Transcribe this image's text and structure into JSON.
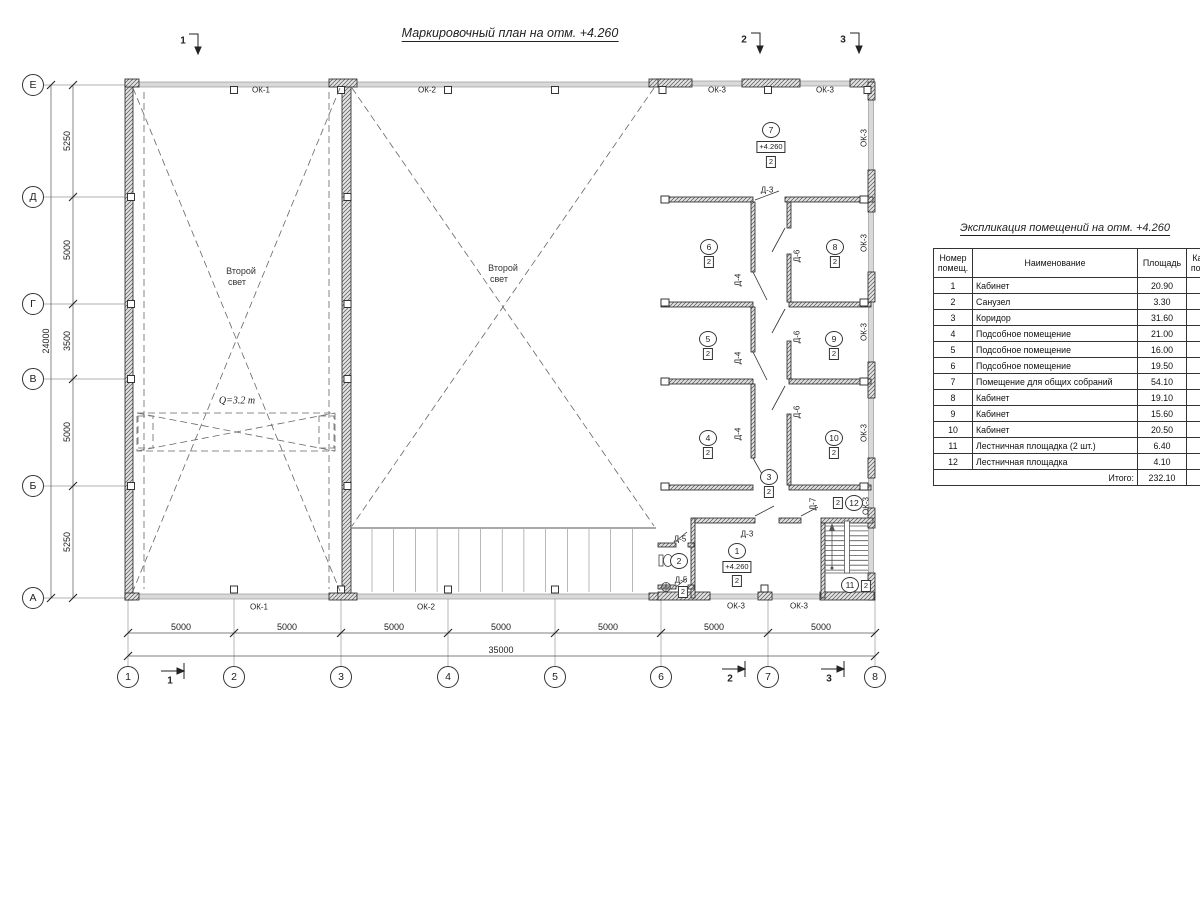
{
  "plan": {
    "title": "Маркировочный план на отм. +4.260",
    "elevation": "+4.260",
    "cat": "2",
    "second_light": [
      "Второй",
      "свет"
    ],
    "crane_label": "Q=3.2 т",
    "sections": [
      "1",
      "2",
      "3"
    ],
    "windows": {
      "ok1": "ОК-1",
      "ok2": "ОК-2",
      "ok3": "ОК-3"
    },
    "doors": {
      "d3": "Д-3",
      "d4": "Д-4",
      "d5": "Д-5",
      "d6": "Д-6",
      "d7": "Д-7"
    },
    "room_nums": [
      "1",
      "2",
      "3",
      "4",
      "5",
      "6",
      "7",
      "8",
      "9",
      "10",
      "11",
      "12"
    ]
  },
  "grid": {
    "row_axes": [
      "Е",
      "Д",
      "Г",
      "В",
      "Б",
      "А"
    ],
    "col_axes": [
      "1",
      "2",
      "3",
      "4",
      "5",
      "6",
      "7",
      "8"
    ],
    "row_dims": [
      "5250",
      "5000",
      "3500",
      "5000",
      "5250"
    ],
    "row_total": "24000",
    "col_dims": [
      "5000",
      "5000",
      "5000",
      "5000",
      "5000",
      "5000",
      "5000"
    ],
    "col_total": "35000"
  },
  "table": {
    "title": "Экспликация помещений на отм. +4.260",
    "columns": [
      "Номер помещ.",
      "Наименование",
      "Площадь",
      "Кат. пом."
    ],
    "rows": [
      {
        "num": "1",
        "name": "Кабинет",
        "area": "20.90",
        "cat": ""
      },
      {
        "num": "2",
        "name": "Санузел",
        "area": "3.30",
        "cat": ""
      },
      {
        "num": "3",
        "name": "Коридор",
        "area": "31.60",
        "cat": ""
      },
      {
        "num": "4",
        "name": "Подсобное помещение",
        "area": "21.00",
        "cat": ""
      },
      {
        "num": "5",
        "name": "Подсобное помещение",
        "area": "16.00",
        "cat": ""
      },
      {
        "num": "6",
        "name": "Подсобное помещение",
        "area": "19.50",
        "cat": ""
      },
      {
        "num": "7",
        "name": "Помещение для общих собраний",
        "area": "54.10",
        "cat": ""
      },
      {
        "num": "8",
        "name": "Кабинет",
        "area": "19.10",
        "cat": ""
      },
      {
        "num": "9",
        "name": "Кабинет",
        "area": "15.60",
        "cat": ""
      },
      {
        "num": "10",
        "name": "Кабинет",
        "area": "20.50",
        "cat": ""
      },
      {
        "num": "11",
        "name": "Лестничная площадка (2 шт.)",
        "area": "6.40",
        "cat": ""
      },
      {
        "num": "12",
        "name": "Лестничная площадка",
        "area": "4.10",
        "cat": ""
      }
    ],
    "total_label": "Итого:",
    "total_value": "232.10"
  }
}
